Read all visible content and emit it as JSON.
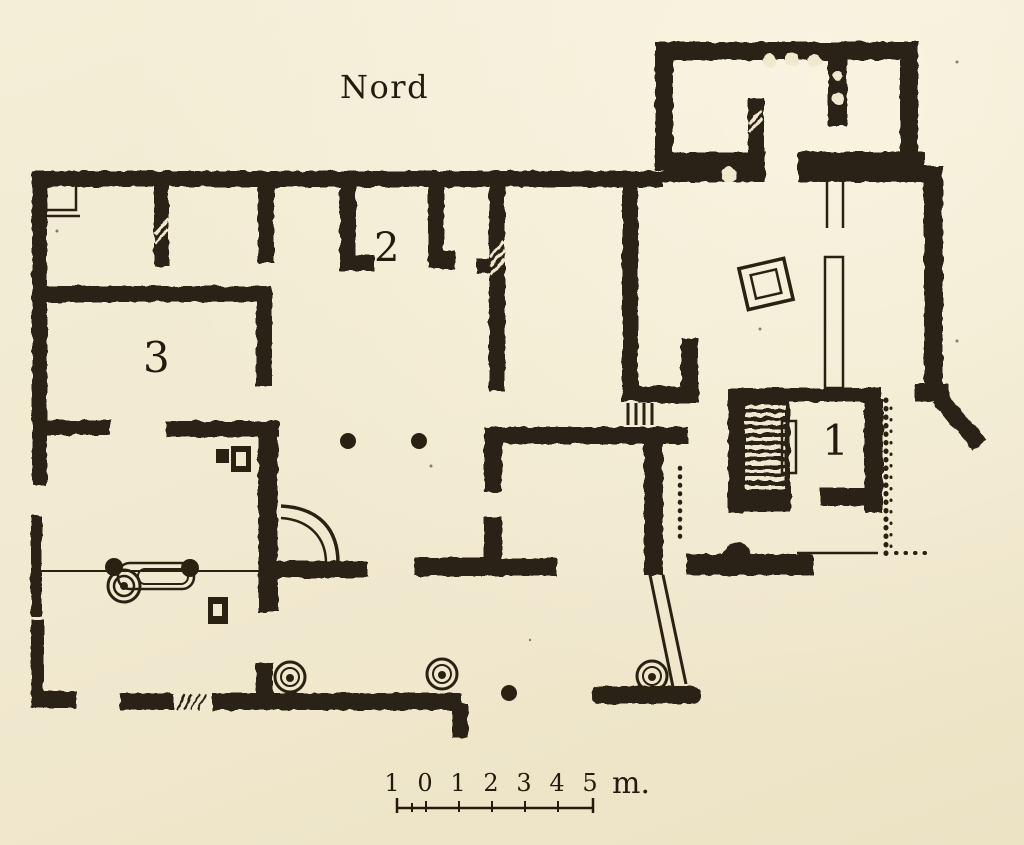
{
  "plan": {
    "kind": "archaeological floor plan (engraved scan)",
    "north_label": "Nord",
    "rooms": [
      {
        "label": "1"
      },
      {
        "label": "2"
      },
      {
        "label": "3"
      }
    ],
    "scale_bar": {
      "marks": [
        "1",
        "0",
        "1",
        "2",
        "3",
        "4",
        "5"
      ],
      "unit": "m."
    },
    "colors": {
      "paper": "#f1e9cf",
      "ink": "#2a2113"
    }
  }
}
